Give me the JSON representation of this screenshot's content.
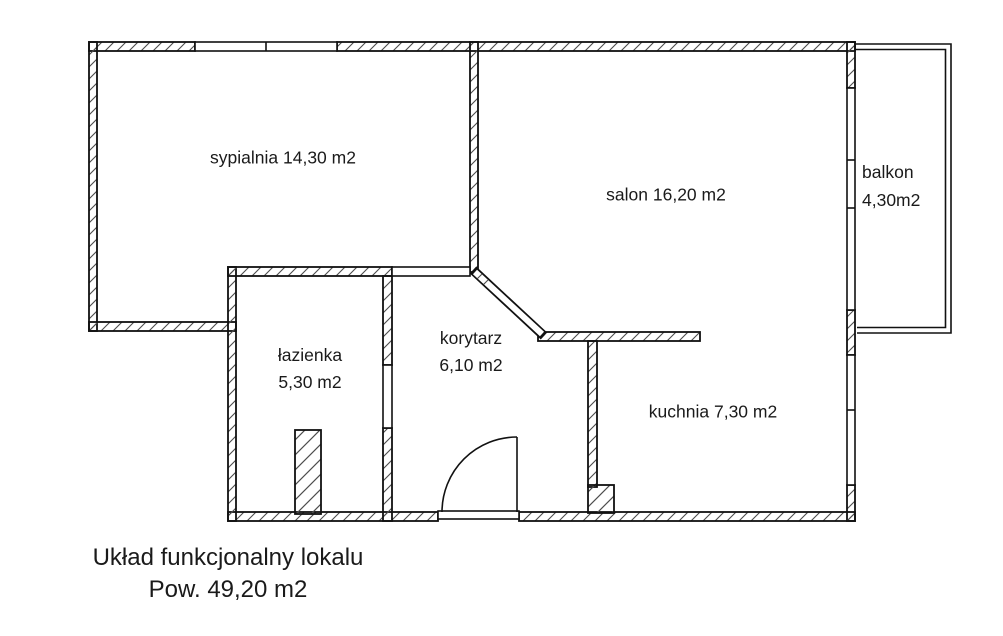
{
  "rooms": {
    "sypialnia": {
      "label": "sypialnia 14,30 m2"
    },
    "salon": {
      "label": "salon 16,20 m2"
    },
    "balkon": {
      "name": "balkon",
      "area": "4,30m2"
    },
    "lazienka": {
      "name": "łazienka",
      "area": "5,30 m2"
    },
    "korytarz": {
      "name": "korytarz",
      "area": "6,10 m2"
    },
    "kuchnia": {
      "label": "kuchnia 7,30 m2"
    }
  },
  "caption": {
    "title": "Układ funkcjonalny lokalu",
    "total_area": "Pow. 49,20 m2"
  },
  "colors": {
    "background": "#ffffff",
    "wall_line": "#111111",
    "hatch_line": "#4d4d4d",
    "text": "#1a1a1a"
  }
}
